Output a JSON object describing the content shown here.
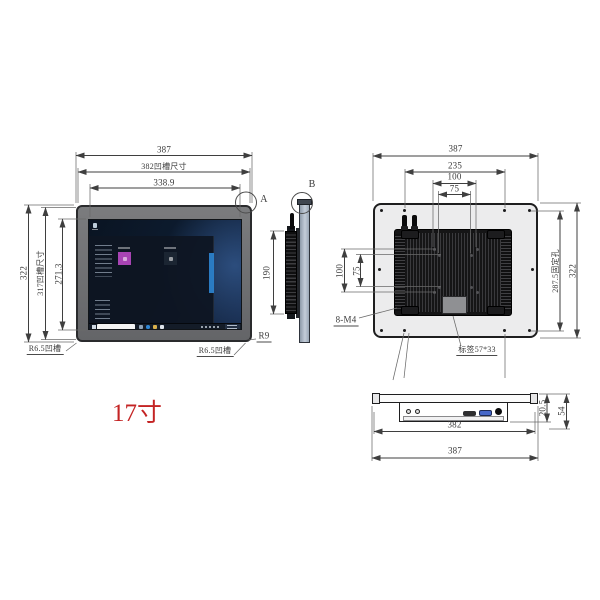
{
  "product": {
    "size_label": "17寸"
  },
  "front_view": {
    "detail_marker": "A",
    "dim_width_outer": "387",
    "dim_width_groove": "382凹槽尺寸",
    "dim_width_screen": "338.9",
    "dim_height_outer": "322",
    "dim_height_groove": "317凹槽尺寸",
    "dim_height_screen": "271.3",
    "corner_radius": "R9",
    "groove_radius_left": "R6.5凹槽",
    "groove_radius_right": "R6.5凹槽"
  },
  "side_view": {
    "detail_marker": "B",
    "dim_heatsink_height": "190"
  },
  "back_view": {
    "dim_width_outer": "387",
    "dim_mount_span": "235",
    "dim_vesa100_h": "100",
    "dim_vesa75_h": "75",
    "dim_vesa100_v": "100",
    "dim_vesa75_v": "75",
    "dim_fixing_holes": "287.5固定孔",
    "dim_height_outer": "322",
    "screw_spec": "8-M4",
    "sticker_size": "标签57*33"
  },
  "bottom_view": {
    "dim_depth_front": "20.5",
    "dim_depth_total": "54",
    "dim_width_groove": "382",
    "dim_width_outer": "387"
  },
  "screen": {
    "accent_blue": "#2e86d4",
    "tiles_left": [
      "#2b82d6",
      "#2b82d6",
      "#3f9be4",
      "#2b82d6",
      "#2f86d8",
      "#1e6fc0",
      "#78909c",
      "#2b82d6",
      "#a844b4"
    ],
    "tiles_right": [
      "#16a11a",
      "#2b82d6",
      "#2b82d6",
      "#3f2f52",
      "#6e3424",
      "#50301d",
      "#c3a258",
      "#e06018",
      "#1b2532"
    ]
  },
  "colors": {
    "dimension_line": "#3f3f3f",
    "size_label_red": "#c42424",
    "bezel_gray": "#6f7072",
    "back_panel_gray": "#ececed"
  }
}
